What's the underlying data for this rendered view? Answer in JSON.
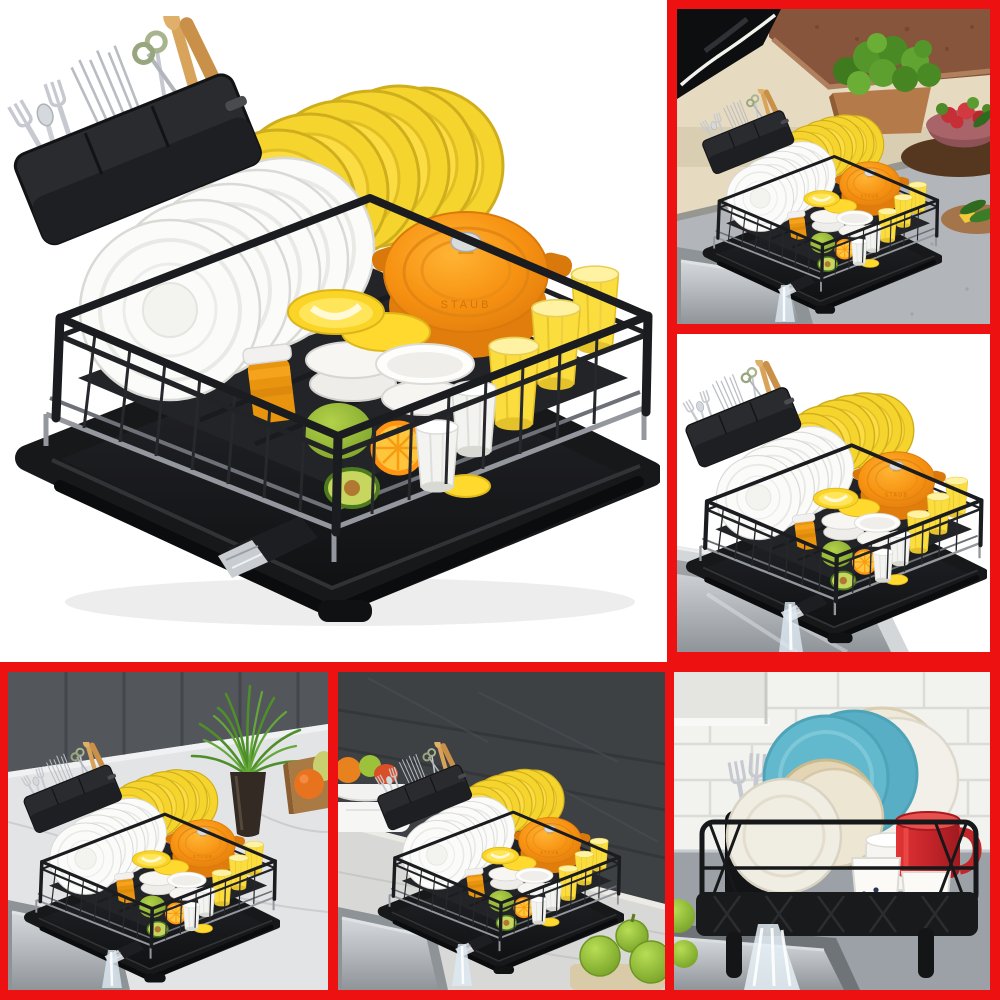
{
  "page": {
    "background": "#ffffff",
    "frame_color": "#ee1111",
    "description": "Six-image product collage of a black dish drying rack"
  },
  "collage": {
    "tiles": [
      {
        "id": "main",
        "label": "Main product view: black wire dish drying rack with yellow and white plates, orange dutch oven, bowls, cups, fruit and utensil caddy on white background",
        "framed": false
      },
      {
        "id": "top-right",
        "label": "Lifestyle view: rack on grey kitchen counter beside black cooktop, wooden planter of kale and pink bowl of radishes",
        "framed": true
      },
      {
        "id": "mid-right",
        "label": "Rack draining through its spout into a stainless steel sink, white background",
        "framed": true
      },
      {
        "id": "bottom-left",
        "label": "Rack on white marble counter with grey cabinets, green plant in dark vase and fruit crate",
        "framed": true
      },
      {
        "id": "bottom-middle",
        "label": "Rack on light wood counter against dark wood-plank wall with fruit bowl and green apples",
        "framed": true
      },
      {
        "id": "bottom-right",
        "label": "Front view of black rack holding blue and cream plates, red mug and polka-dot cups, draining into sink before white subway tiles",
        "framed": true
      }
    ]
  },
  "scene": {
    "pot_brand": "STAUB",
    "colors": {
      "rack_black": "#1b1c1f",
      "tray_black": "#17181a",
      "silver_rail": "#94979d",
      "plate_yellow": "#f6d42e",
      "plate_white": "#fbfbfa",
      "pot_orange": "#f79212",
      "cup_yellow": "#fbde3d",
      "lime_green": "#9cc23b",
      "orange_fruit": "#ffb52b",
      "honey_amber": "#e8940f",
      "mug_red": "#cc2127",
      "plate_blue": "#62b8cc",
      "plate_cream": "#e4d6b4",
      "kale_green": "#55962b",
      "radish_red": "#c62f36",
      "counter_grey": "#b4b8bc",
      "cabinet_grey": "#53565b",
      "wood_wall": "#3e4144",
      "subway_tile": "#f2f2ef",
      "steel": "#b7bbc0"
    }
  }
}
